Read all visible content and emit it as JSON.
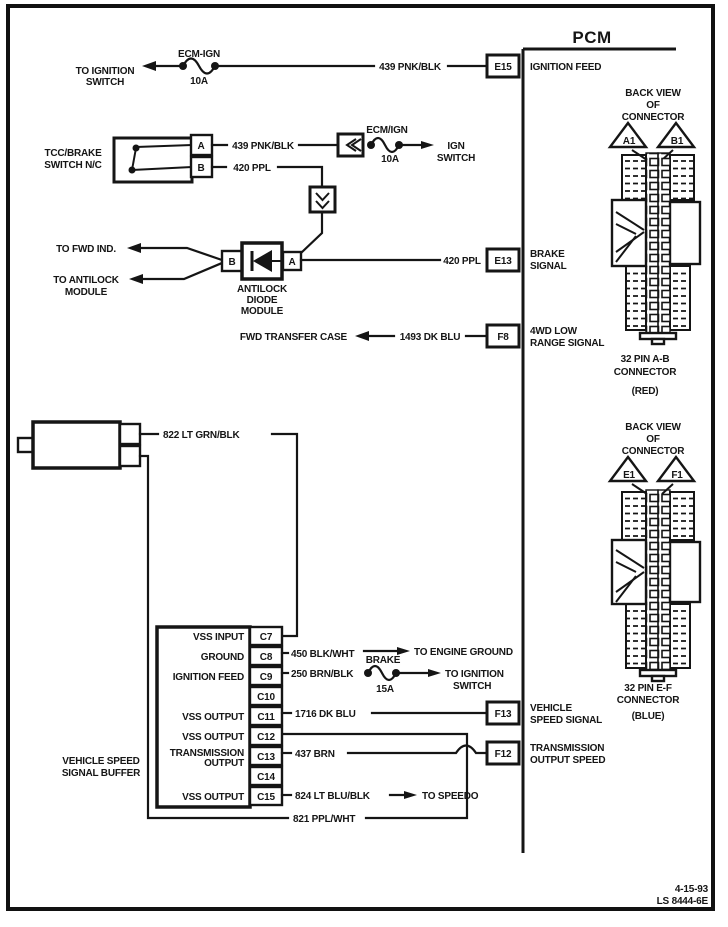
{
  "pcm": {
    "title": "PCM"
  },
  "top": {
    "to_ignition_1": "TO IGNITION",
    "to_ignition_2": "SWITCH",
    "fuse_name": "ECM-IGN",
    "fuse_amp": "10A",
    "wire": "439 PNK/BLK",
    "pin": "E15",
    "pin_label": "IGNITION FEED"
  },
  "tcc": {
    "label1": "TCC/BRAKE",
    "label2": "SWITCH N/C",
    "term_a": "A",
    "term_b": "B",
    "wire_a": "439 PNK/BLK",
    "fuse_name": "ECM/IGN",
    "fuse_amp": "10A",
    "ign1": "IGN",
    "ign2": "SWITCH",
    "wire_b": "420 PPL"
  },
  "diode": {
    "to_fwd": "TO FWD IND.",
    "to_antilock1": "TO ANTILOCK",
    "to_antilock2": "MODULE",
    "term_b": "B",
    "term_a": "A",
    "name1": "ANTILOCK",
    "name2": "DIODE",
    "name3": "MODULE",
    "wire": "420 PPL",
    "pin": "E13",
    "pin_label1": "BRAKE",
    "pin_label2": "SIGNAL"
  },
  "transfer": {
    "dest": "FWD TRANSFER CASE",
    "wire": "1493 DK BLU",
    "pin": "F8",
    "pin_label1": "4WD LOW",
    "pin_label2": "RANGE SIGNAL"
  },
  "conn_ab": {
    "bv1": "BACK VIEW",
    "bv2": "OF",
    "bv3": "CONNECTOR",
    "t1": "A1",
    "t2": "B1",
    "cap1": "32 PIN A-B",
    "cap2": "CONNECTOR",
    "cap3": "(RED)"
  },
  "conn_ef": {
    "bv1": "BACK VIEW",
    "bv2": "OF",
    "bv3": "CONNECTOR",
    "t1": "E1",
    "t2": "F1",
    "cap1": "32 PIN E-F",
    "cap2": "CONNECTOR",
    "cap3": "(BLUE)"
  },
  "vss": {
    "wire_hi": "822 LT GRN/BLK",
    "wire_lo": "821 PPL/WHT",
    "buffer1": "VEHICLE SPEED",
    "buffer2": "SIGNAL BUFFER",
    "pins": [
      {
        "id": "C7",
        "label": "VSS INPUT"
      },
      {
        "id": "C8",
        "label": "GROUND"
      },
      {
        "id": "C9",
        "label": "IGNITION FEED"
      },
      {
        "id": "C10",
        "label": ""
      },
      {
        "id": "C11",
        "label": "VSS OUTPUT"
      },
      {
        "id": "C12",
        "label": "VSS OUTPUT"
      },
      {
        "id": "C13",
        "label": "TRANSMISSION",
        "label2": "OUTPUT"
      },
      {
        "id": "C14",
        "label": ""
      },
      {
        "id": "C15",
        "label": "VSS OUTPUT"
      }
    ],
    "wire_gnd": "450 BLK/WHT",
    "to_engine_ground": "TO ENGINE GROUND",
    "wire_ign": "250 BRN/BLK",
    "fuse_name": "BRAKE",
    "fuse_amp": "15A",
    "to_ign1": "TO IGNITION",
    "to_ign2": "SWITCH",
    "wire_vss": "1716 DK BLU",
    "pin_f13": "F13",
    "f13_1": "VEHICLE",
    "f13_2": "SPEED SIGNAL",
    "wire_trans": "437 BRN",
    "pin_f12": "F12",
    "f12_1": "TRANSMISSION",
    "f12_2": "OUTPUT SPEED",
    "wire_speedo": "824 LT BLU/BLK",
    "to_speedo": "TO SPEEDO"
  },
  "footer": {
    "date": "4-15-93",
    "code": "LS 8444-6E"
  }
}
